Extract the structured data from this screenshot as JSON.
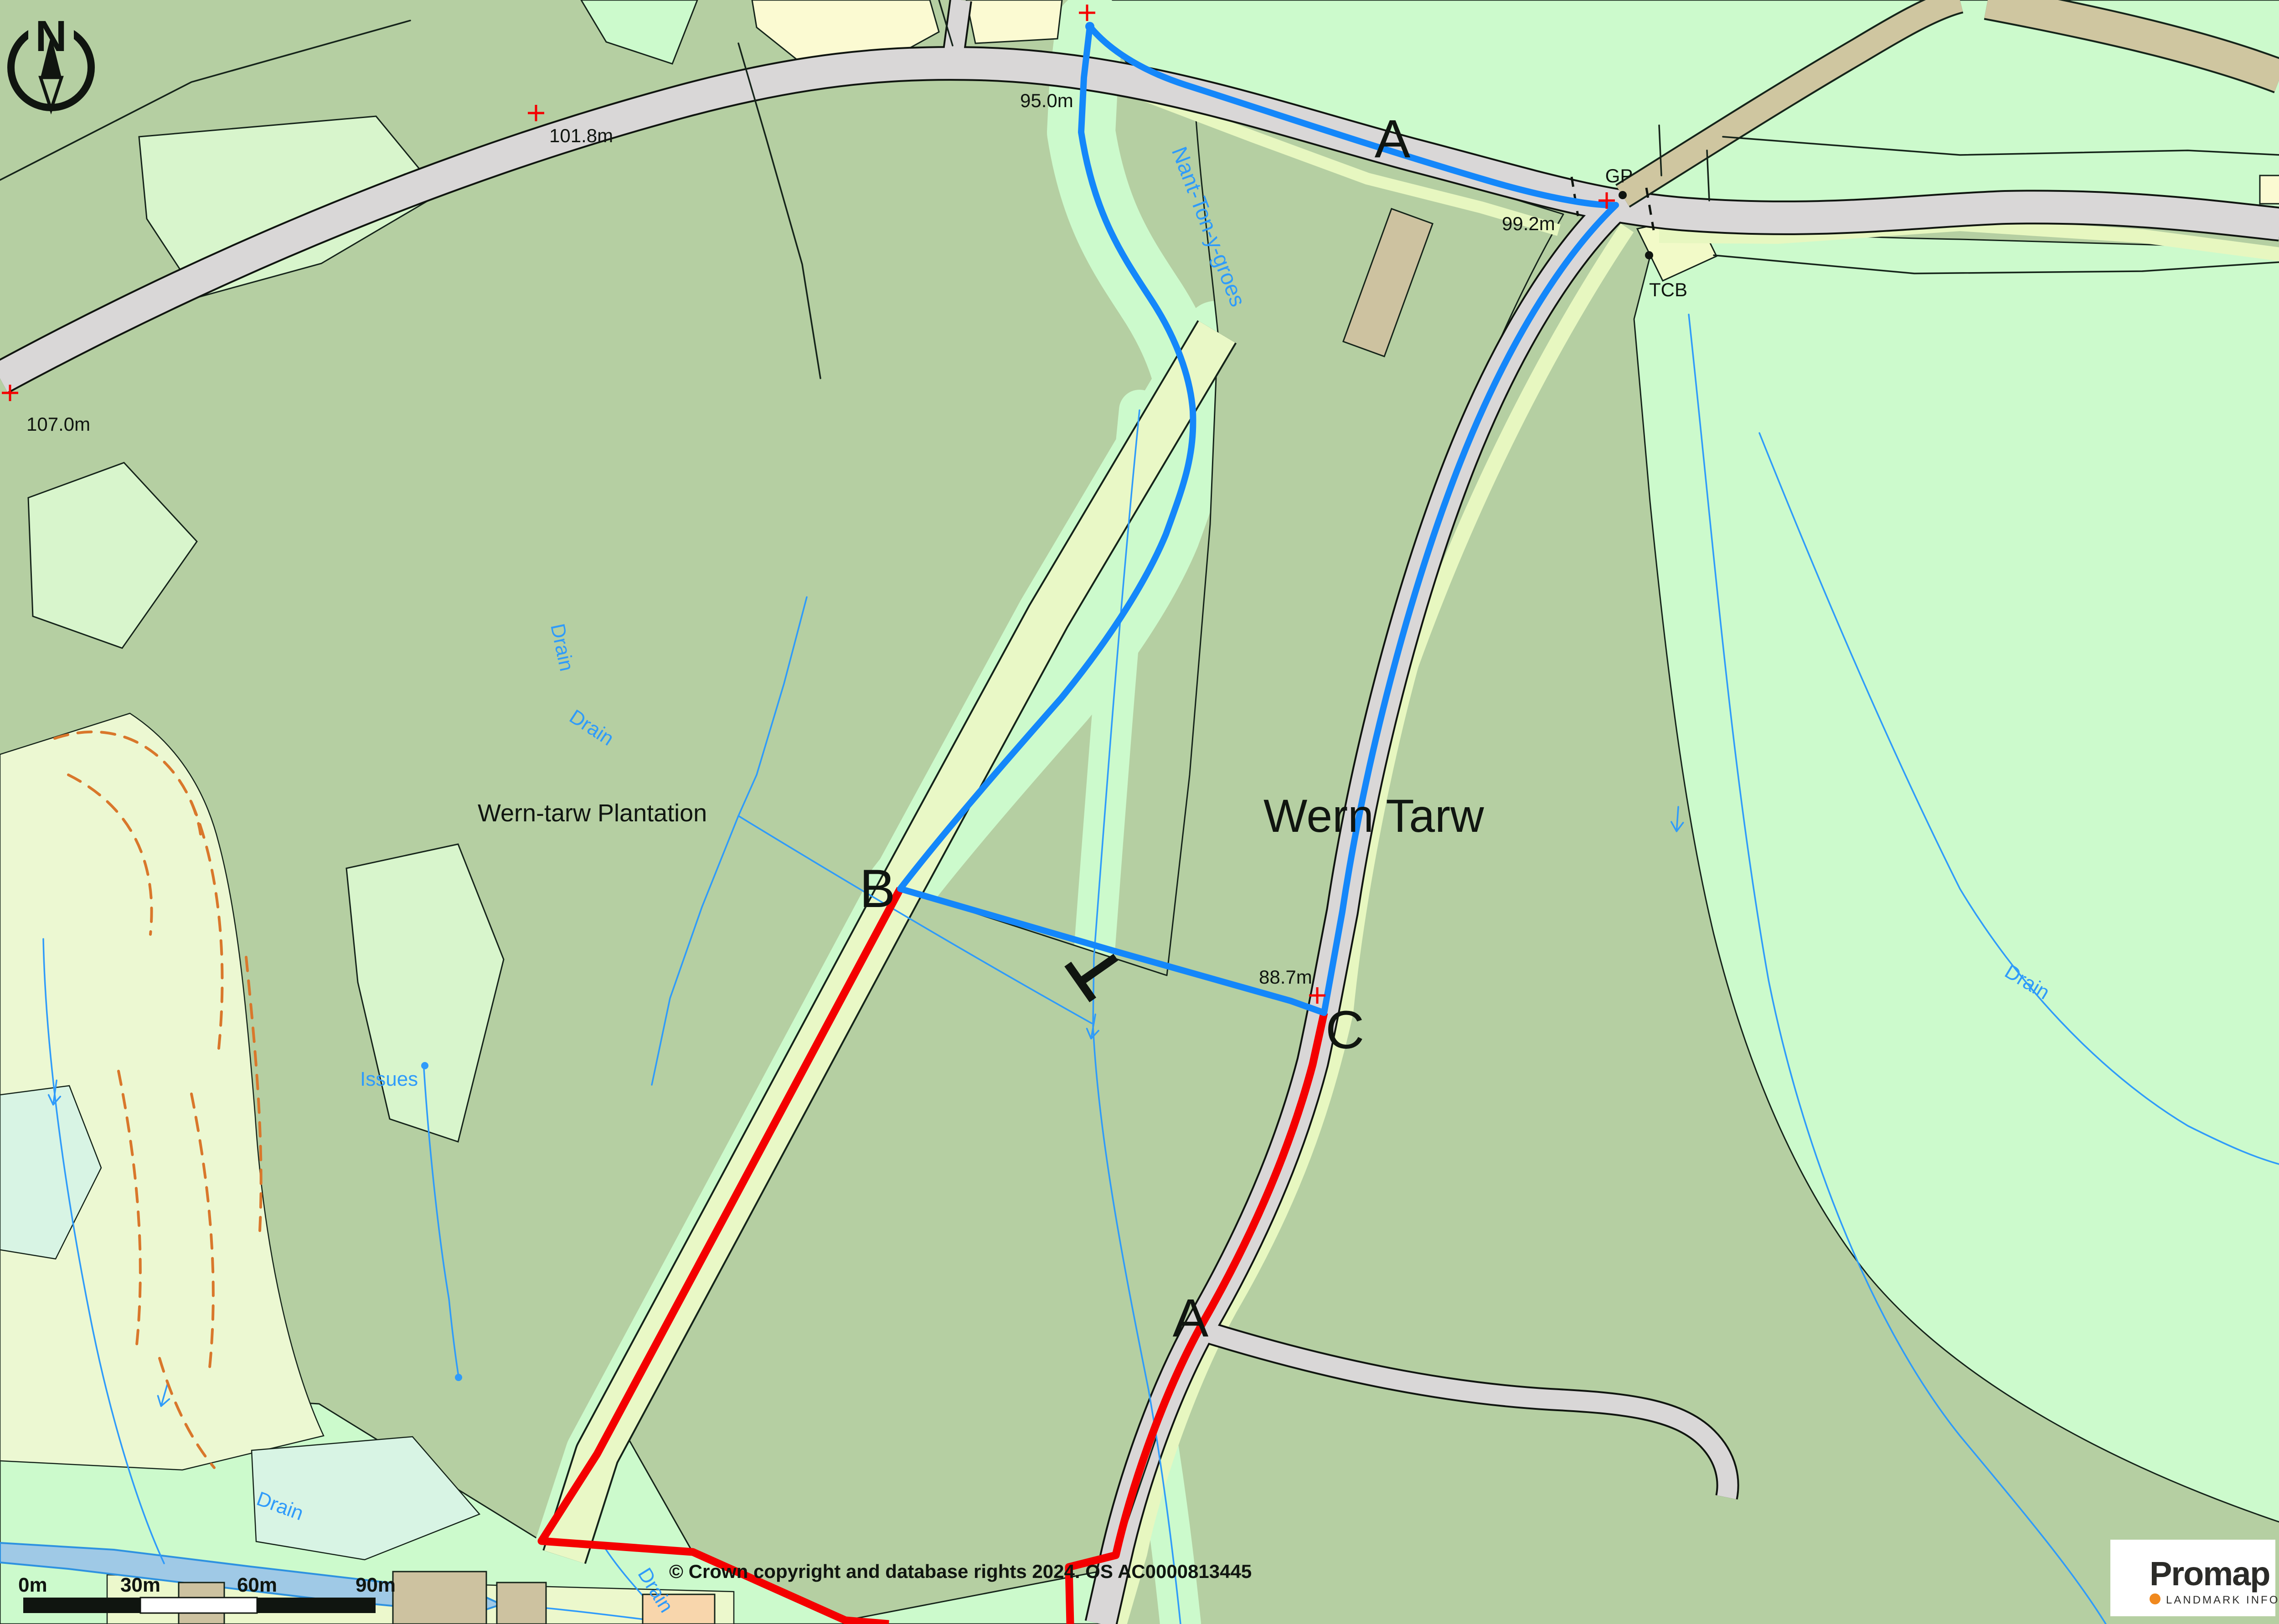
{
  "map": {
    "place_labels": {
      "wern_tarw": "Wern Tarw",
      "plantation": "Wern-tarw Plantation",
      "stream_name": "Nant-Ton-y-groes",
      "issues": "Issues",
      "gp": "GP",
      "tcb": "TCB"
    },
    "spot_heights": {
      "h95": "95.0m",
      "h99": "99.2m",
      "h101": "101.8m",
      "h107": "107.0m",
      "h88": "88.7m"
    },
    "point_markers": {
      "a_top": "A",
      "a_bottom": "A",
      "b": "B",
      "c": "C"
    },
    "drain_label": "Drain",
    "compass_north": "N"
  },
  "scale_bar": {
    "t0": "0m",
    "t30": "30m",
    "t60": "60m",
    "t90": "90m"
  },
  "attribution": "© Crown copyright and database rights 2024. OS AC0000813445",
  "logo": {
    "brand": "Promap",
    "subtitle": "LANDMARK INFORMATION",
    "dot_color": "#f0891e"
  },
  "colors": {
    "rough_pasture": "#b5cfa2",
    "field_mint": "#ccfacc",
    "track_pale": "#e9f8c6",
    "road_grey": "#d9d7d7",
    "water_fill": "#9fc9e6",
    "water_line": "#2f9bfa",
    "boundary_blue": "#1487fa",
    "boundary_red": "#f40000",
    "building_tan": "#cdc2a0",
    "building_peach": "#f8d6ac"
  }
}
